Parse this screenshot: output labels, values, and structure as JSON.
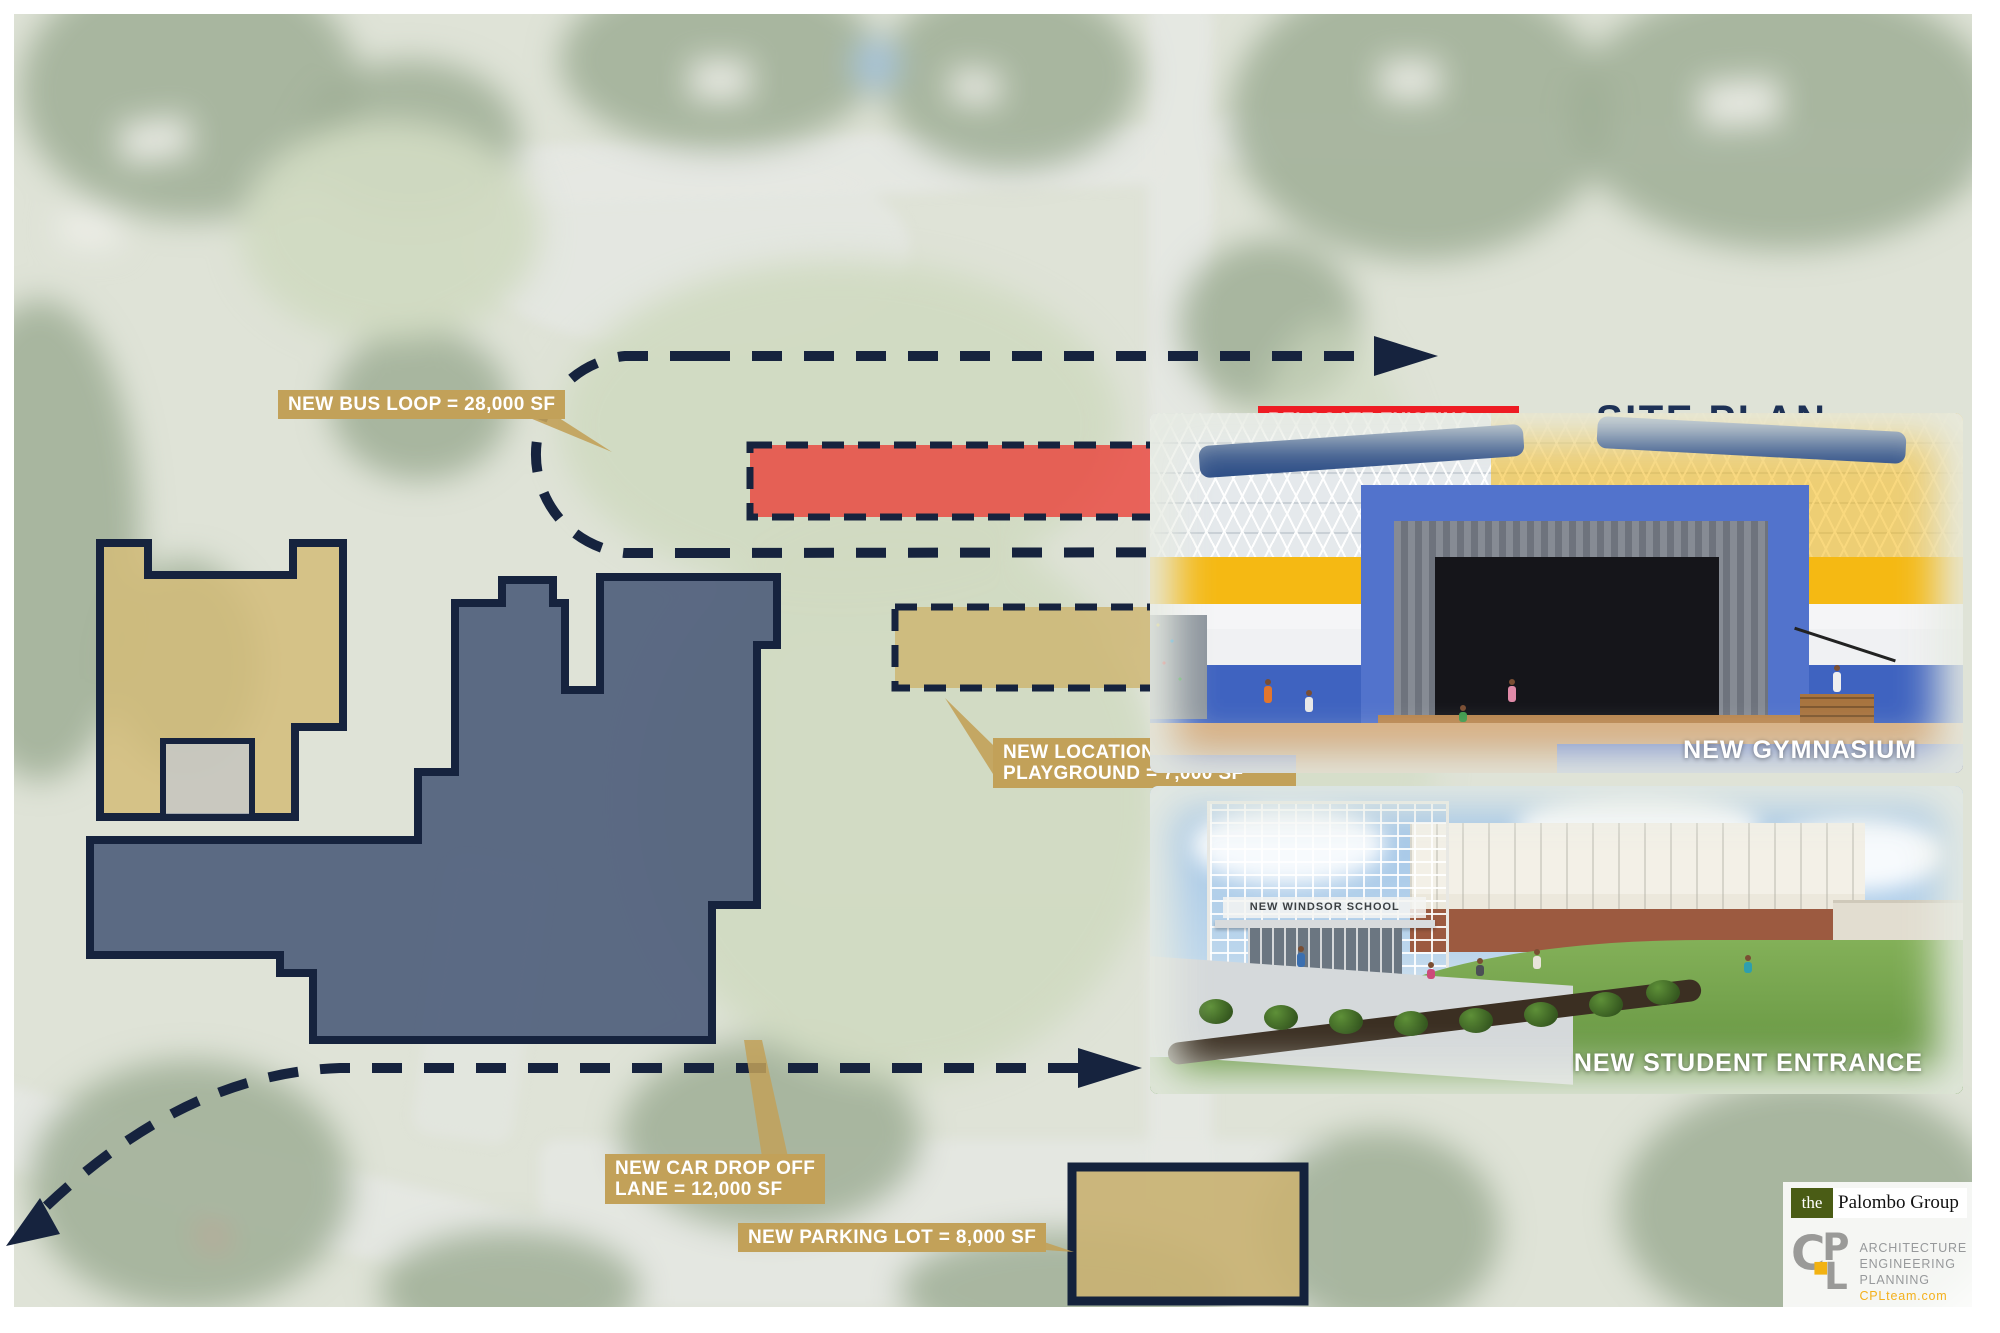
{
  "title": "SITE PLAN",
  "annotations": {
    "bus_loop": {
      "label": "NEW BUS LOOP = 28,000 SF"
    },
    "relocate_playground": {
      "line1": "RELOCATE EXISTING",
      "line2": "PLAYGROUND = 7,000 SF"
    },
    "new_location": {
      "line1": "NEW LOCATION OF EXISTING",
      "line2": "PLAYGROUND = 7,000 SF"
    },
    "car_drop_off": {
      "line1": "NEW CAR DROP OFF",
      "line2": "LANE = 12,000 SF"
    },
    "parking_lot": {
      "label": "NEW PARKING LOT = 8,000 SF"
    }
  },
  "renderings": {
    "gymnasium": {
      "caption": "NEW GYMNASIUM"
    },
    "student_entrance": {
      "caption": "NEW STUDENT ENTRANCE",
      "building_sign": "NEW WINDSOR SCHOOL"
    }
  },
  "branding": {
    "palombo": {
      "prefix": "the",
      "name": "Palombo Group"
    },
    "cpl": {
      "monogram_c": "C",
      "monogram_p": "P",
      "monogram_l": "L",
      "services": [
        "ARCHITECTURE",
        "ENGINEERING",
        "PLANNING"
      ],
      "website": "CPLteam.com"
    }
  },
  "colors": {
    "navy": "#16233e",
    "tan_label": "#c2a159",
    "red_label": "#ee1c23",
    "building_slate": "#586685",
    "building_tan": "#d3bc79",
    "cpl_yellow": "#f2b211"
  }
}
